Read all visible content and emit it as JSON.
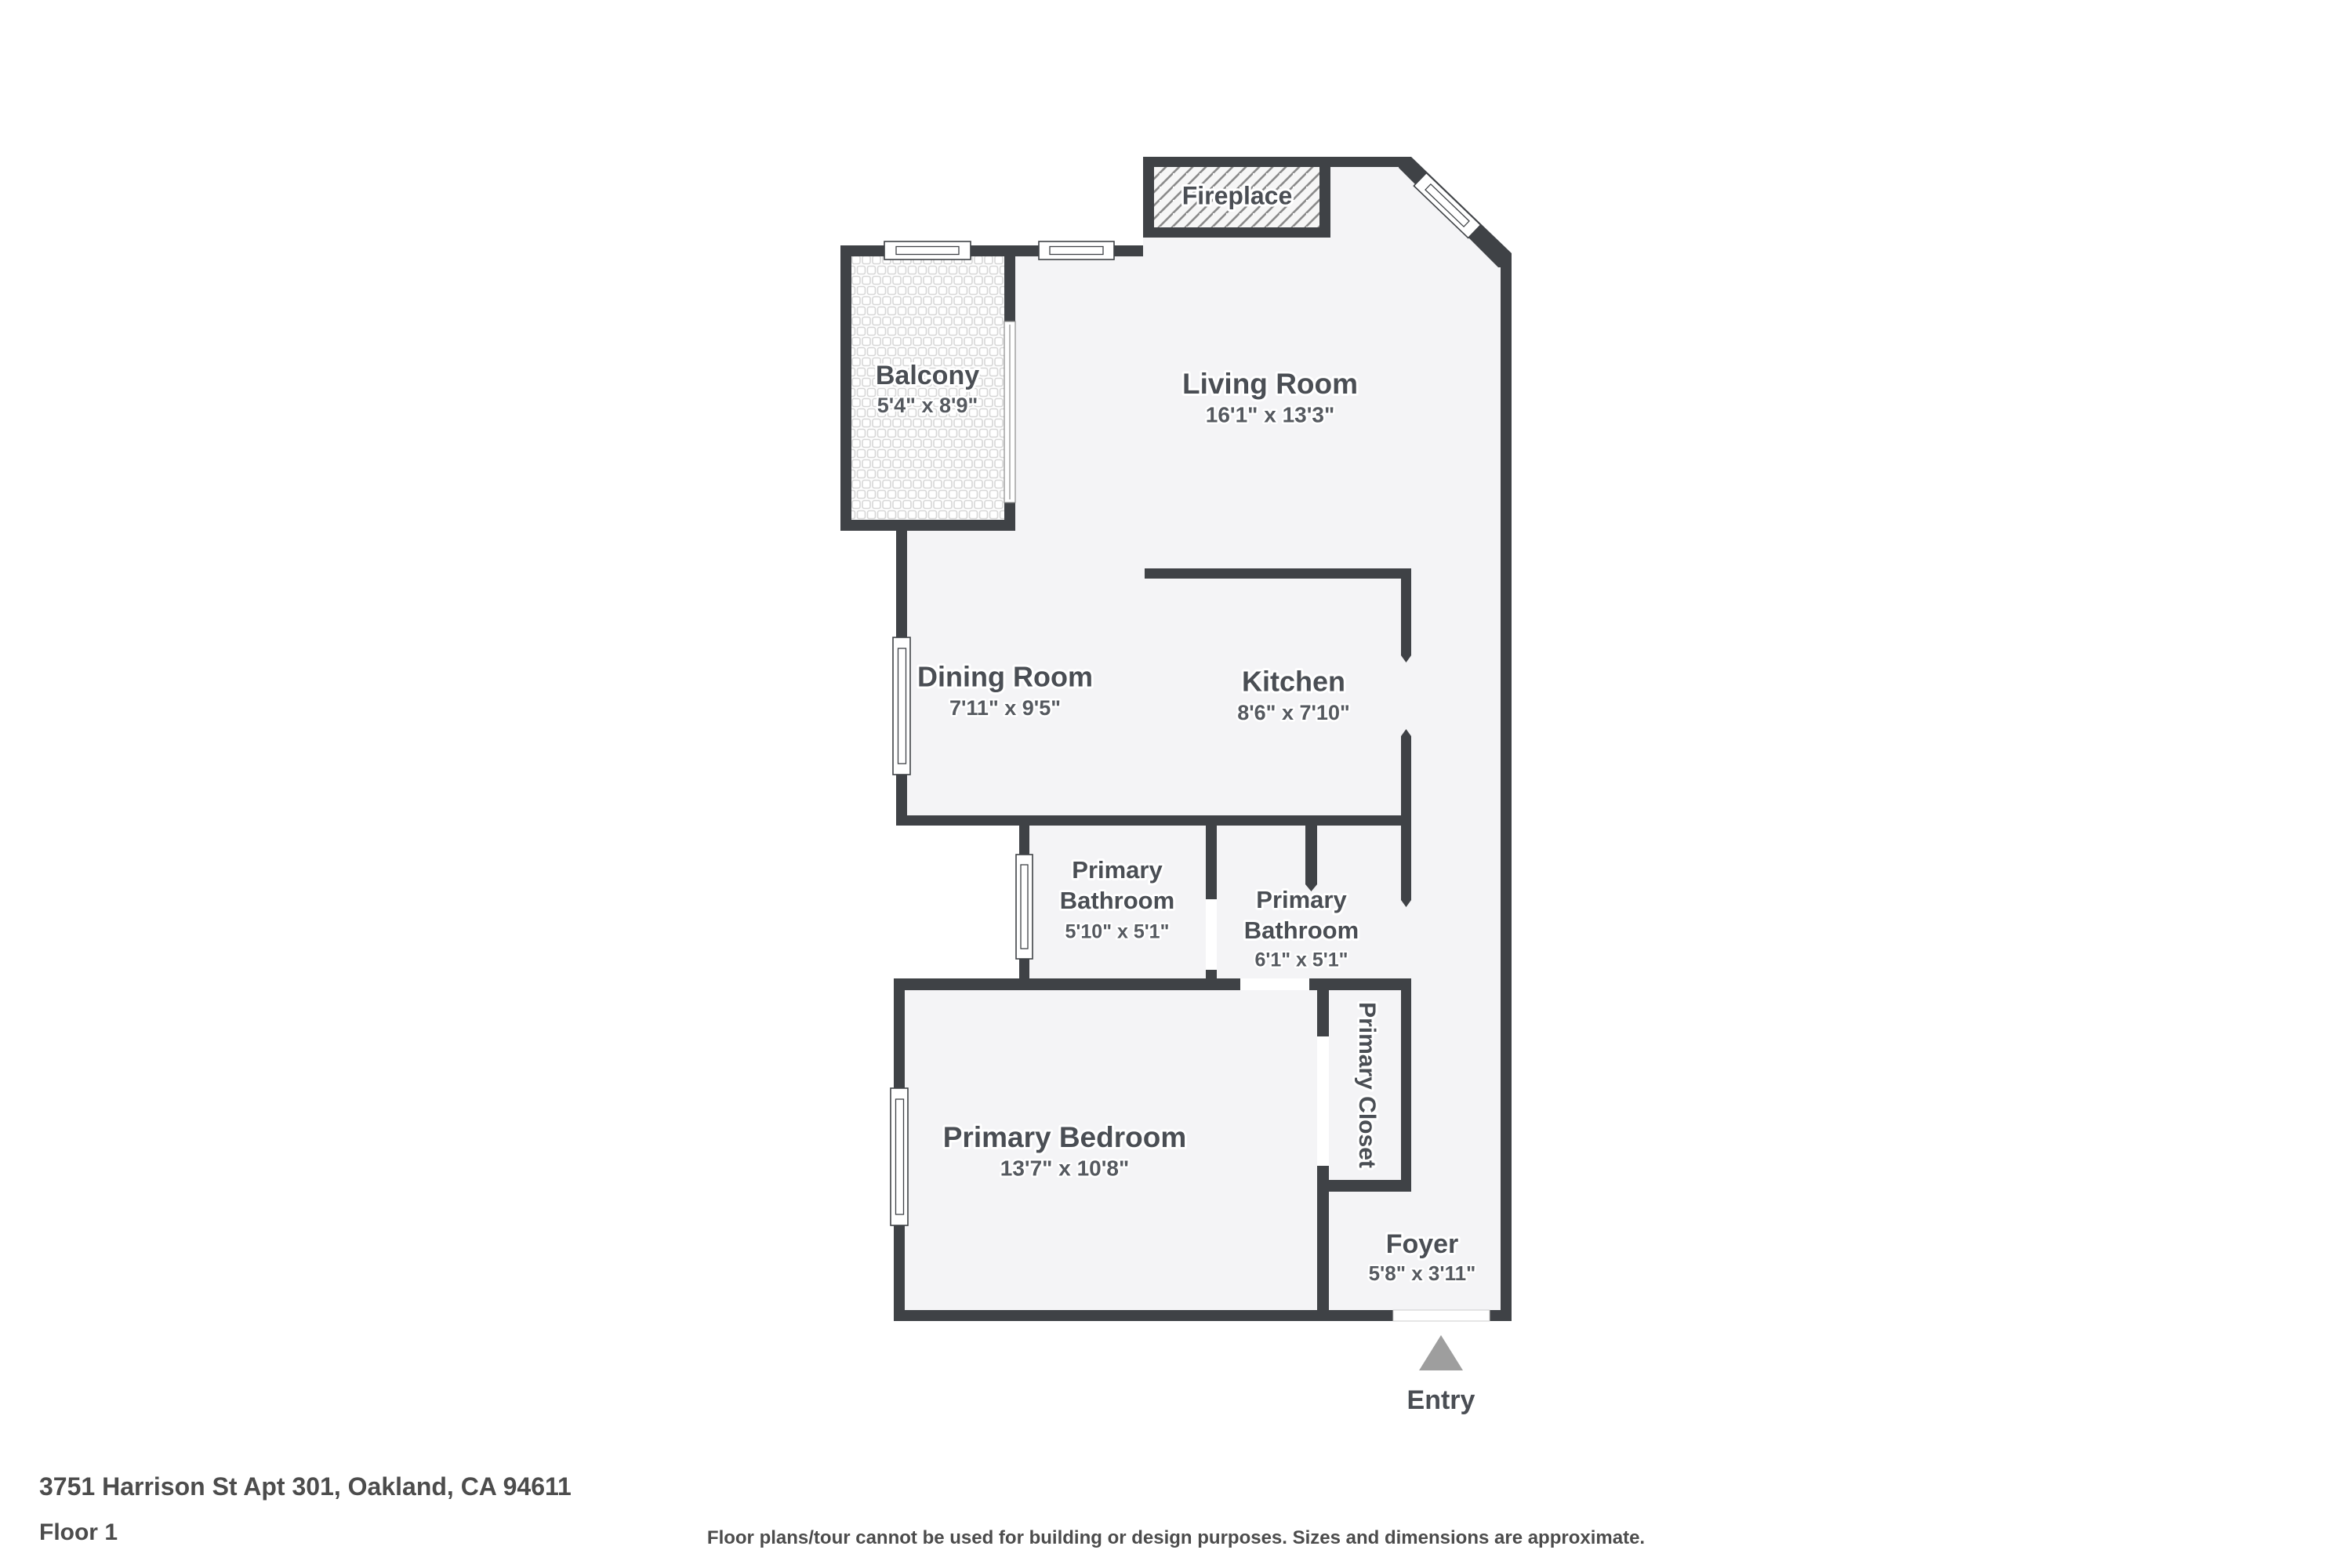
{
  "rooms": {
    "balcony": {
      "name": "Balcony",
      "dims": "5'4\" x 8'9\""
    },
    "living": {
      "name": "Living Room",
      "dims": "16'1\" x 13'3\""
    },
    "dining": {
      "name": "Dining Room",
      "dims": "7'11\" x 9'5\""
    },
    "kitchen": {
      "name": "Kitchen",
      "dims": "8'6\" x 7'10\""
    },
    "bath1": {
      "line1": "Primary",
      "line2": "Bathroom",
      "dims": "5'10\" x 5'1\""
    },
    "bath2": {
      "line1": "Primary",
      "line2": "Bathroom",
      "dims": "6'1\" x 5'1\""
    },
    "bedroom": {
      "name": "Primary Bedroom",
      "dims": "13'7\" x 10'8\""
    },
    "closet": {
      "name": "Primary Closet"
    },
    "foyer": {
      "name": "Foyer",
      "dims": "5'8\" x 3'11\""
    }
  },
  "features": {
    "fireplace": "Fireplace",
    "entry": "Entry"
  },
  "footer": {
    "address": "3751 Harrison St Apt 301, Oakland, CA 94611",
    "floor": "Floor 1",
    "disclaimer": "Floor plans/tour cannot be used for building or design purposes. Sizes and dimensions are approximate."
  },
  "colors": {
    "wall": "#3f4246",
    "floor": "#f4f4f6",
    "label_text": "#4a4e54",
    "entry_arrow": "#9e9e9e"
  }
}
